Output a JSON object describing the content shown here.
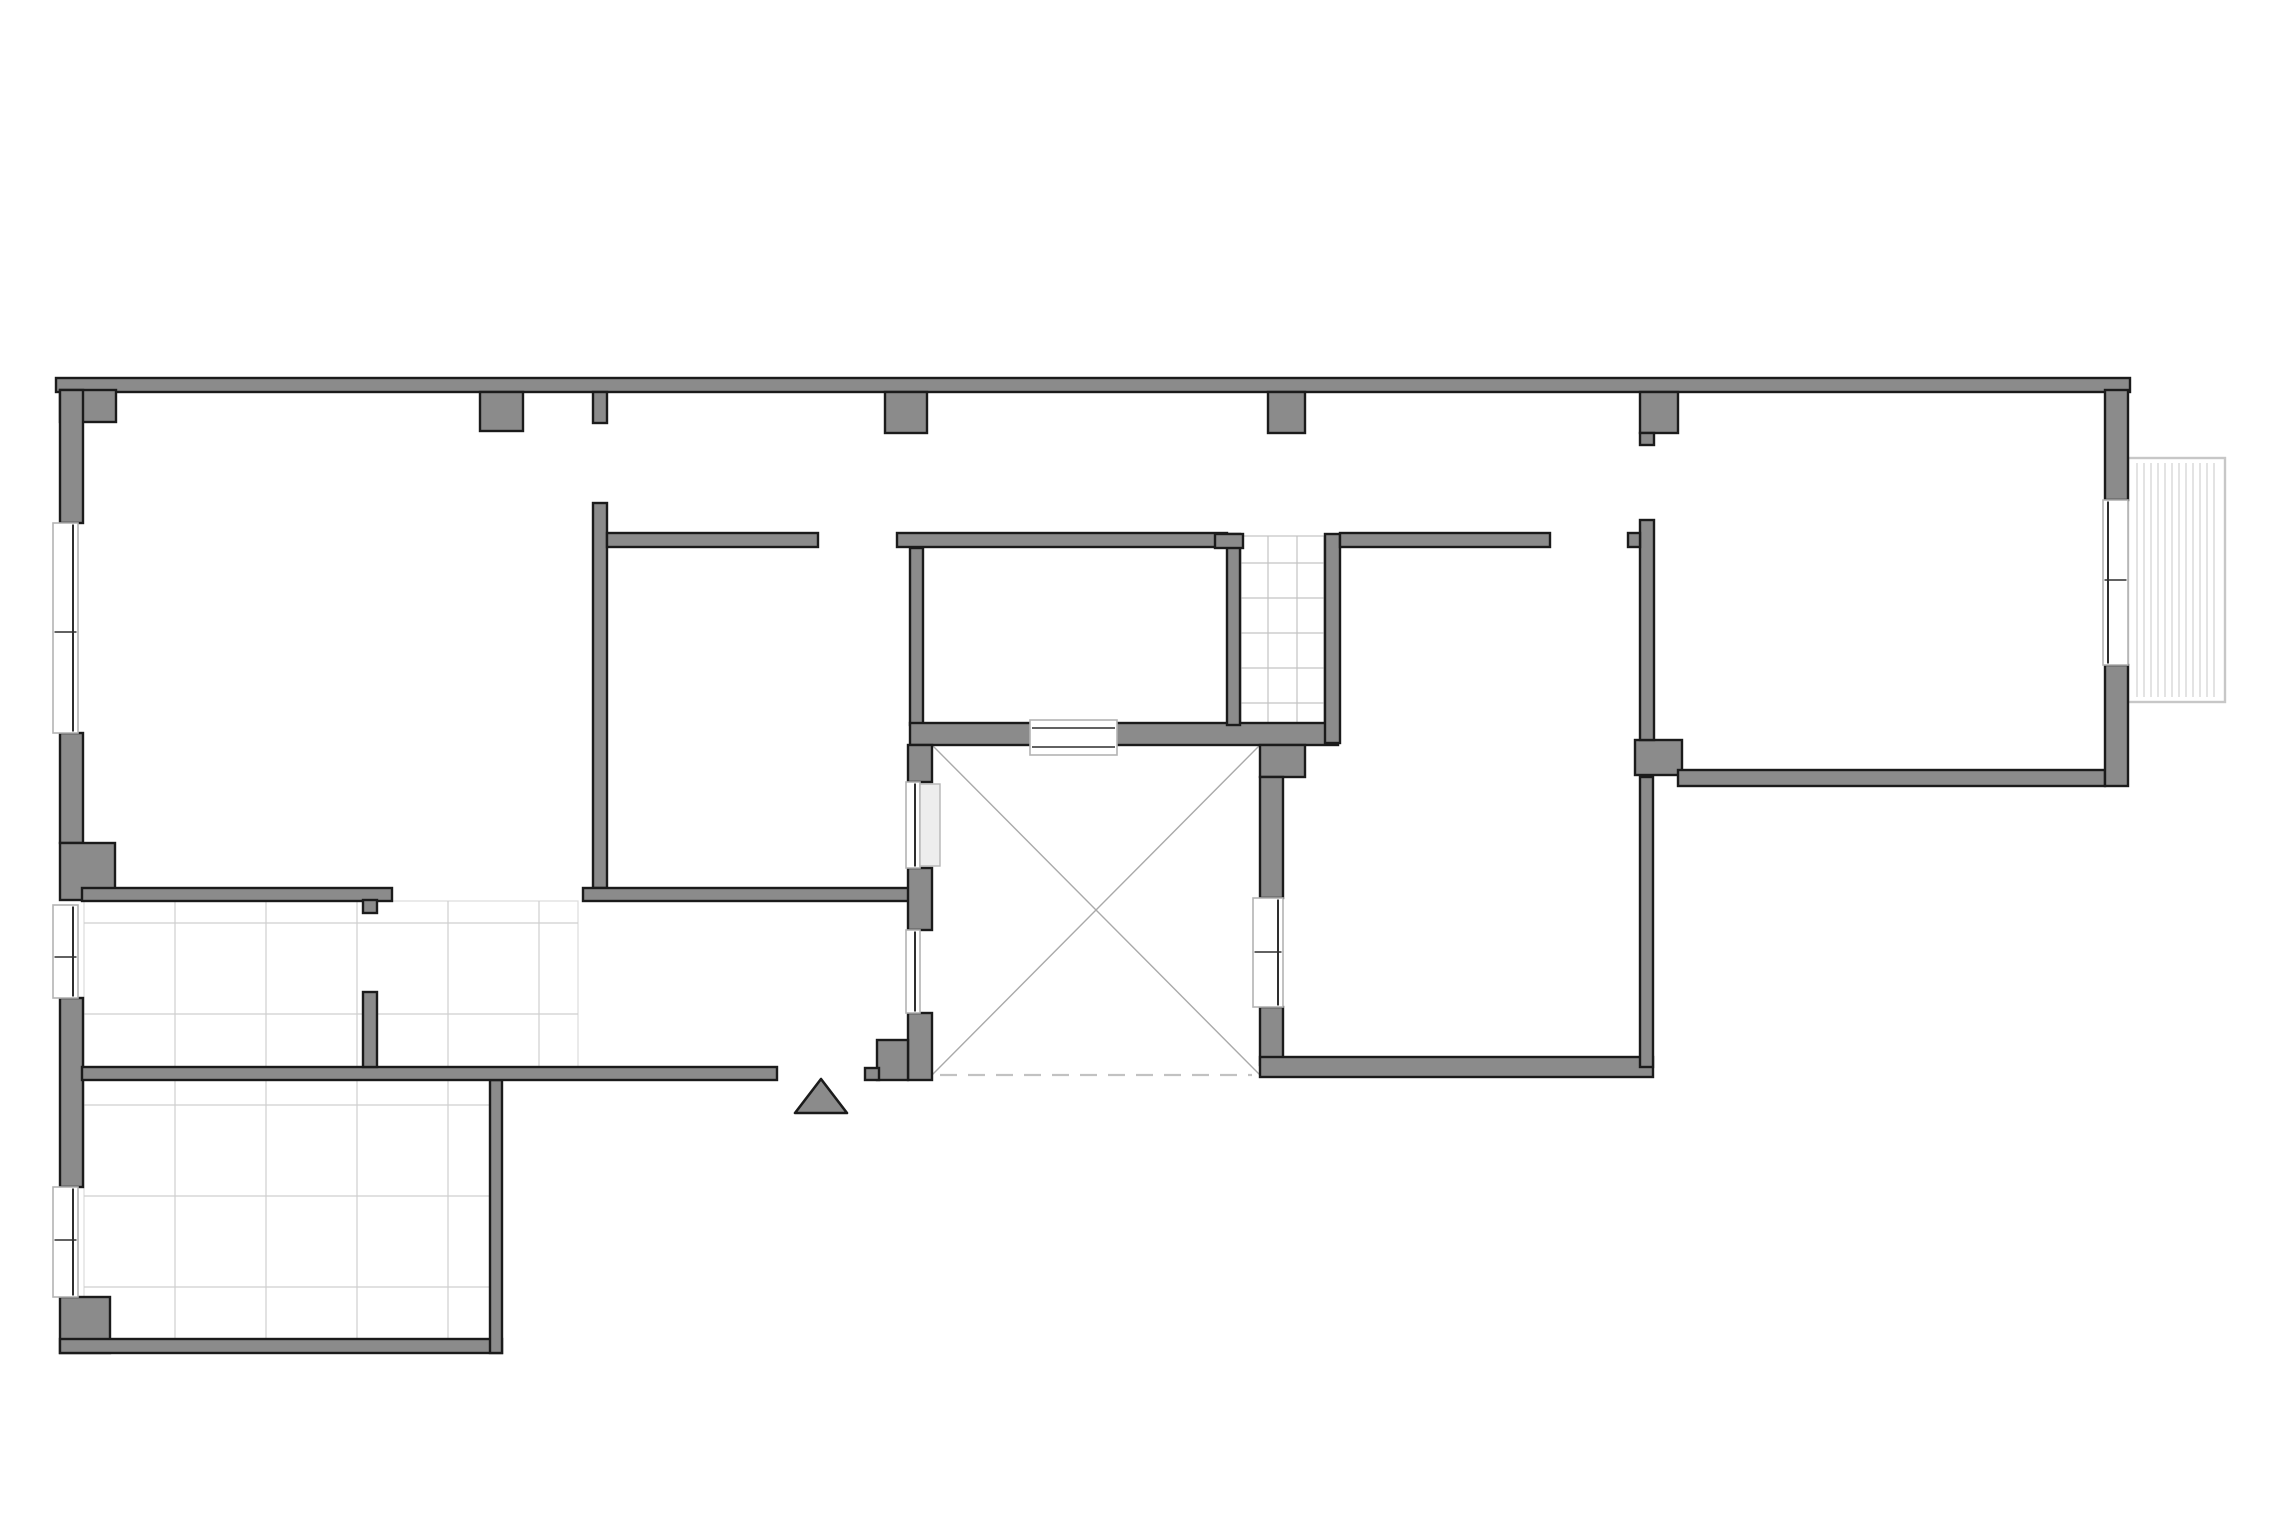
{
  "canvas": {
    "w": 2280,
    "h": 1522,
    "bg": "#ffffff"
  },
  "style": {
    "wall_fill": "#8b8b8b",
    "wall_stroke": "#1b1b1b",
    "wall_stroke_w": 2.4,
    "tile_line": "#cfcfcf",
    "tile_edge": "#dcdcdc",
    "shaft_line": "#c3c3c3",
    "diag_line": "#a9a9a9",
    "dash_line": "#c2c2c2",
    "window_box": "#b3b3b3",
    "window_glass": "#2e2e2e",
    "balcony_line": "#c7c7c7",
    "leaf_fill": "#ededed",
    "leaf_stroke": "#b5b5b5"
  },
  "plan": {
    "walls": [
      {
        "name": "top-exterior-wall",
        "x": 56,
        "y": 378,
        "w": 2074,
        "h": 14
      },
      {
        "name": "top-left-corner-block",
        "x": 60,
        "y": 390,
        "w": 56,
        "h": 32
      },
      {
        "name": "left-wall-upper",
        "x": 60,
        "y": 390,
        "w": 23,
        "h": 133
      },
      {
        "name": "left-wall-mid",
        "x": 60,
        "y": 733,
        "w": 23,
        "h": 110
      },
      {
        "name": "left-wall-corner-block-mid",
        "x": 60,
        "y": 843,
        "w": 55,
        "h": 57
      },
      {
        "name": "left-wall-lower",
        "x": 60,
        "y": 998,
        "w": 23,
        "h": 189
      },
      {
        "name": "bottom-left-corner-block",
        "x": 60,
        "y": 1297,
        "w": 50,
        "h": 56
      },
      {
        "name": "bottom-wall-left",
        "x": 60,
        "y": 1339,
        "w": 442,
        "h": 14
      },
      {
        "name": "kitchen-east-wall",
        "x": 490,
        "y": 1080,
        "w": 12,
        "h": 273
      },
      {
        "name": "south-wall-mid",
        "x": 82,
        "y": 1067,
        "w": 695,
        "h": 13
      },
      {
        "name": "kitchen-north-wall",
        "x": 82,
        "y": 888,
        "w": 310,
        "h": 13
      },
      {
        "name": "kitchen-door-tab",
        "x": 363,
        "y": 900,
        "w": 14,
        "h": 13
      },
      {
        "name": "kitchen-door-jamb",
        "x": 363,
        "y": 992,
        "w": 14,
        "h": 75
      },
      {
        "name": "hall-west-wall",
        "x": 593,
        "y": 503,
        "w": 14,
        "h": 385
      },
      {
        "name": "hall-west-wall-top-stub",
        "x": 593,
        "y": 392,
        "w": 14,
        "h": 31
      },
      {
        "name": "partition-h1",
        "x": 607,
        "y": 533,
        "w": 211,
        "h": 14
      },
      {
        "name": "hall-south-wall",
        "x": 583,
        "y": 888,
        "w": 327,
        "h": 13
      },
      {
        "name": "partition-w2",
        "x": 910,
        "y": 548,
        "w": 13,
        "h": 177
      },
      {
        "name": "partition-h2",
        "x": 897,
        "y": 533,
        "w": 330,
        "h": 14
      },
      {
        "name": "courtyard-north-wall",
        "x": 910,
        "y": 723,
        "w": 428,
        "h": 22
      },
      {
        "name": "entry-column-block-upper",
        "x": 908,
        "y": 745,
        "w": 24,
        "h": 37
      },
      {
        "name": "entry-column-block-lower",
        "x": 908,
        "y": 868,
        "w": 24,
        "h": 62
      },
      {
        "name": "entry-jamb-tall",
        "x": 908,
        "y": 1013,
        "w": 24,
        "h": 67
      },
      {
        "name": "entry-jamb-mid",
        "x": 877,
        "y": 1040,
        "w": 31,
        "h": 40
      },
      {
        "name": "entry-jamb-low",
        "x": 865,
        "y": 1068,
        "w": 14,
        "h": 12
      },
      {
        "name": "stair-shaft-west-wall",
        "x": 1227,
        "y": 534,
        "w": 13,
        "h": 191
      },
      {
        "name": "stair-shaft-west-tab",
        "x": 1215,
        "y": 534,
        "w": 28,
        "h": 14
      },
      {
        "name": "stair-shaft-east-wall",
        "x": 1325,
        "y": 534,
        "w": 15,
        "h": 209
      },
      {
        "name": "partition-h3",
        "x": 1340,
        "y": 533,
        "w": 210,
        "h": 14
      },
      {
        "name": "courtyard-east-block",
        "x": 1260,
        "y": 745,
        "w": 45,
        "h": 32
      },
      {
        "name": "courtyard-east-wall-upper",
        "x": 1260,
        "y": 777,
        "w": 23,
        "h": 121
      },
      {
        "name": "courtyard-east-wall-lower",
        "x": 1260,
        "y": 1007,
        "w": 23,
        "h": 58
      },
      {
        "name": "bedroom-south-wall",
        "x": 1260,
        "y": 1057,
        "w": 393,
        "h": 20
      },
      {
        "name": "bedroom-east-wall",
        "x": 1640,
        "y": 777,
        "w": 13,
        "h": 290
      },
      {
        "name": "right-junction-block",
        "x": 1635,
        "y": 740,
        "w": 47,
        "h": 35
      },
      {
        "name": "right-room-west-wall",
        "x": 1640,
        "y": 520,
        "w": 14,
        "h": 220
      },
      {
        "name": "right-room-west-tab",
        "x": 1628,
        "y": 533,
        "w": 12,
        "h": 14
      },
      {
        "name": "right-room-south-wall",
        "x": 1678,
        "y": 770,
        "w": 427,
        "h": 16
      },
      {
        "name": "right-wall-upper",
        "x": 2105,
        "y": 390,
        "w": 23,
        "h": 110
      },
      {
        "name": "right-wall-lower",
        "x": 2105,
        "y": 665,
        "w": 23,
        "h": 121
      }
    ],
    "pilasters": [
      {
        "name": "pilaster-1",
        "x": 480,
        "y": 392,
        "w": 43,
        "h": 39
      },
      {
        "name": "pilaster-2",
        "x": 885,
        "y": 392,
        "w": 42,
        "h": 41
      },
      {
        "name": "pilaster-3",
        "x": 1268,
        "y": 392,
        "w": 37,
        "h": 41
      },
      {
        "name": "pilaster-4",
        "x": 1640,
        "y": 392,
        "w": 38,
        "h": 41
      },
      {
        "name": "pilaster-4-stub",
        "x": 1640,
        "y": 433,
        "w": 14,
        "h": 12
      }
    ],
    "windows": [
      {
        "name": "window-left-upper",
        "x": 53,
        "y": 523,
        "w": 25,
        "h": 210,
        "orient": "v",
        "face": "right",
        "dividers": [
          632
        ]
      },
      {
        "name": "window-left-mid",
        "x": 53,
        "y": 905,
        "w": 25,
        "h": 93,
        "orient": "v",
        "face": "right",
        "dividers": [
          957
        ]
      },
      {
        "name": "window-left-lower",
        "x": 53,
        "y": 1187,
        "w": 25,
        "h": 110,
        "orient": "v",
        "face": "right",
        "dividers": [
          1240
        ]
      },
      {
        "name": "window-right-balcony",
        "x": 2103,
        "y": 500,
        "w": 25,
        "h": 165,
        "orient": "v",
        "face": "left",
        "dividers": [
          580
        ]
      },
      {
        "name": "window-bedroom-courtyard",
        "x": 1253,
        "y": 898,
        "w": 30,
        "h": 109,
        "orient": "v",
        "face": "right",
        "dividers": [
          952
        ]
      },
      {
        "name": "window-courtyard-north",
        "x": 1030,
        "y": 720,
        "w": 87,
        "h": 35,
        "orient": "h",
        "face": "both",
        "dividers": []
      },
      {
        "name": "door-hall-courtyard",
        "x": 906,
        "y": 782,
        "w": 14,
        "h": 86,
        "orient": "v",
        "face": "right",
        "dividers": []
      },
      {
        "name": "entry-sidelight",
        "x": 906,
        "y": 930,
        "w": 14,
        "h": 83,
        "orient": "v",
        "face": "right",
        "dividers": []
      }
    ],
    "floor_grids": [
      {
        "name": "tiled-floor-upper",
        "x": 84,
        "y": 901,
        "w": 494,
        "h": 166,
        "vx": [
          175,
          266,
          357,
          448,
          539
        ],
        "hy": [
          923,
          1014
        ]
      },
      {
        "name": "tiled-floor-lower",
        "x": 84,
        "y": 1080,
        "w": 406,
        "h": 262,
        "vx": [
          175,
          266,
          357,
          448
        ],
        "hy": [
          1105,
          1196,
          1287
        ]
      }
    ],
    "stair_shaft": {
      "name": "stair-shaft-treads",
      "x": 1241,
      "y": 536,
      "w": 83,
      "h": 188,
      "vx": [
        1268,
        1297
      ],
      "hy": [
        563,
        598,
        633,
        668,
        703
      ]
    },
    "courtyard": {
      "name": "courtyard-void",
      "x": 932,
      "y": 745,
      "w": 328,
      "h": 330,
      "dash_y": 1075,
      "dash_x1": 940,
      "dash_x2": 1252
    },
    "balcony": {
      "name": "balcony",
      "x": 2128,
      "y": 458,
      "w": 97,
      "h": 244,
      "spacing": 7
    },
    "door_leaf": {
      "name": "door-leaf-hall-courtyard",
      "x": 920,
      "y": 784,
      "w": 20,
      "h": 82
    },
    "entrance_marker": {
      "name": "entrance-arrow",
      "points": "795,1113 847,1113 821,1079"
    }
  }
}
